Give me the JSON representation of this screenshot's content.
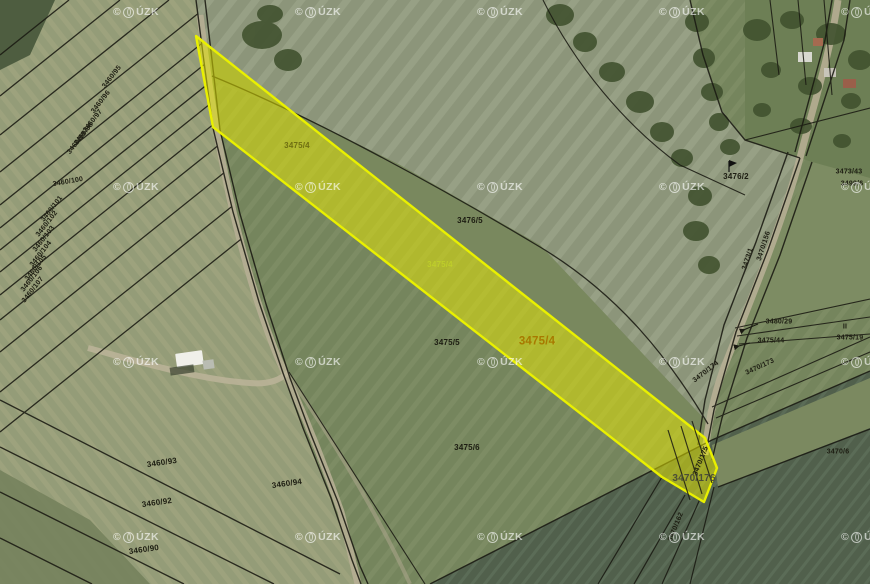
{
  "map": {
    "watermark": {
      "prefix": "©",
      "logo_icon": "cuzk-globe-icon",
      "suffix": "ÚZK",
      "grid_x": [
        136,
        318,
        500,
        682,
        864
      ],
      "grid_y": [
        12,
        187,
        362,
        537
      ]
    },
    "highlight_color": "#e9f000",
    "selected_parcels": [
      "3475/4",
      "3470/176"
    ],
    "parcel_labels": [
      {
        "text": "3460/95",
        "x": 112,
        "y": 77,
        "rot": -52,
        "style": "tiny"
      },
      {
        "text": "3460/96",
        "x": 101,
        "y": 102,
        "rot": -52,
        "style": "tiny"
      },
      {
        "text": "3460/97",
        "x": 93,
        "y": 121,
        "rot": -52,
        "style": "tiny"
      },
      {
        "text": "3460/98",
        "x": 84,
        "y": 134,
        "rot": -52,
        "style": "tiny"
      },
      {
        "text": "3460/99",
        "x": 77,
        "y": 143,
        "rot": -52,
        "style": "tiny"
      },
      {
        "text": "3460/100",
        "x": 68,
        "y": 182,
        "rot": -10,
        "style": "tiny"
      },
      {
        "text": "3460/101",
        "x": 52,
        "y": 209,
        "rot": -52,
        "style": "tiny"
      },
      {
        "text": "3460/102",
        "x": 47,
        "y": 224,
        "rot": -52,
        "style": "tiny"
      },
      {
        "text": "3460/103",
        "x": 44,
        "y": 239,
        "rot": -52,
        "style": "tiny"
      },
      {
        "text": "3460/104",
        "x": 41,
        "y": 254,
        "rot": -52,
        "style": "tiny"
      },
      {
        "text": "3460/105",
        "x": 36,
        "y": 268,
        "rot": -52,
        "style": "tiny"
      },
      {
        "text": "3460/106",
        "x": 32,
        "y": 279,
        "rot": -52,
        "style": "tiny"
      },
      {
        "text": "3460/107",
        "x": 33,
        "y": 290,
        "rot": -52,
        "style": "tiny"
      },
      {
        "text": "3460/93",
        "x": 162,
        "y": 463,
        "rot": -8
      },
      {
        "text": "3460/94",
        "x": 287,
        "y": 484,
        "rot": -8
      },
      {
        "text": "3460/92",
        "x": 157,
        "y": 503,
        "rot": -8
      },
      {
        "text": "3460/90",
        "x": 144,
        "y": 550,
        "rot": -8
      },
      {
        "text": "3475/4",
        "x": 297,
        "y": 146,
        "rot": 0,
        "style": "strip"
      },
      {
        "text": "3475/4",
        "x": 440,
        "y": 265,
        "rot": 0,
        "style": "stripL"
      },
      {
        "text": "3476/5",
        "x": 470,
        "y": 221,
        "rot": 0
      },
      {
        "text": "3475/5",
        "x": 447,
        "y": 343,
        "rot": 0
      },
      {
        "text": "3475/4",
        "x": 537,
        "y": 342,
        "rot": 0,
        "style": "sel"
      },
      {
        "text": "3475/6",
        "x": 467,
        "y": 448,
        "rot": 0
      },
      {
        "text": "3476/2",
        "x": 736,
        "y": 177,
        "rot": 0
      },
      {
        "text": "3473/43",
        "x": 849,
        "y": 172,
        "rot": 0,
        "style": "tiny"
      },
      {
        "text": "3499/6",
        "x": 852,
        "y": 184,
        "rot": 0,
        "style": "tiny"
      },
      {
        "text": "3473/1",
        "x": 748,
        "y": 259,
        "rot": -72,
        "style": "tiny"
      },
      {
        "text": "3470/156",
        "x": 764,
        "y": 246,
        "rot": -72,
        "style": "tiny"
      },
      {
        "text": "3480/29",
        "x": 779,
        "y": 322,
        "rot": 0,
        "style": "tiny"
      },
      {
        "text": "3475/44",
        "x": 771,
        "y": 341,
        "rot": 0,
        "style": "tiny"
      },
      {
        "text": "3470/173",
        "x": 760,
        "y": 367,
        "rot": -25,
        "style": "tiny"
      },
      {
        "text": "II",
        "x": 845,
        "y": 327,
        "rot": 0,
        "style": "tiny"
      },
      {
        "text": "3475/19",
        "x": 850,
        "y": 338,
        "rot": 0,
        "style": "tiny"
      },
      {
        "text": "3470/174",
        "x": 706,
        "y": 372,
        "rot": -38,
        "style": "tiny"
      },
      {
        "text": "3470/175",
        "x": 701,
        "y": 461,
        "rot": -68,
        "style": "tiny"
      },
      {
        "text": "3470/176",
        "x": 694,
        "y": 479,
        "rot": 0,
        "style": "sel2"
      },
      {
        "text": "3470/162",
        "x": 676,
        "y": 527,
        "rot": -68,
        "style": "tiny"
      },
      {
        "text": "3470/6",
        "x": 838,
        "y": 452,
        "rot": 0,
        "style": "tiny"
      }
    ]
  }
}
